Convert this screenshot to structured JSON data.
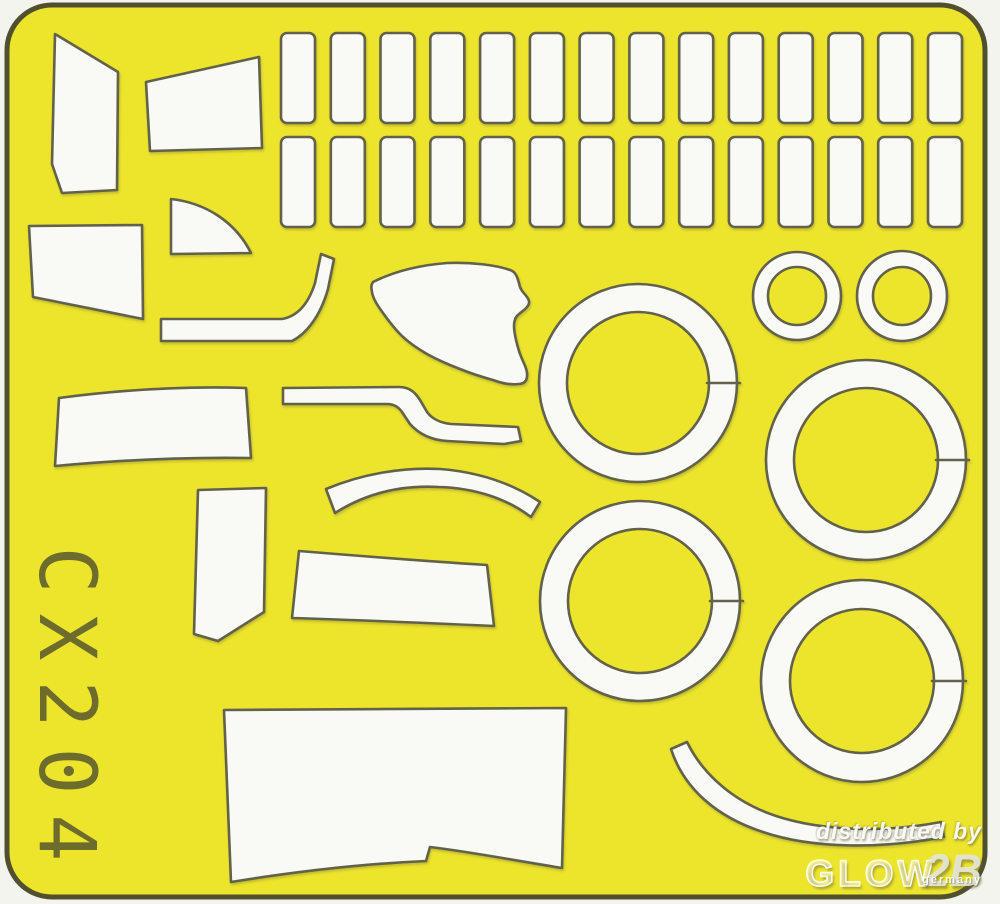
{
  "sheet": {
    "product_code": "CX204",
    "colors": {
      "page_background": "#f4f4ee",
      "sheet_yellow": "#ede42c",
      "sheet_border": "#50502f",
      "cut_outline": "#62624a",
      "mask_white": "#f9f9f6",
      "code_text": "#5c5c2e"
    },
    "frame": {
      "x": 7,
      "y": 5,
      "width": 978,
      "height": 892,
      "corner_radius": 45,
      "border_width": 5
    },
    "mask_grid": {
      "rows": 2,
      "cols": 14,
      "x_start": 281,
      "pitch": 49.77,
      "row_y": [
        33,
        137
      ],
      "mask_width": 34,
      "mask_height": 90,
      "corner_radius": 6
    },
    "rings_large": [
      {
        "name": "large-ring-1",
        "cx": 638,
        "cy": 383,
        "r_outer": 99,
        "r_inner": 71
      },
      {
        "name": "large-ring-2",
        "cx": 866,
        "cy": 460,
        "r_outer": 100,
        "r_inner": 72
      },
      {
        "name": "large-ring-3",
        "cx": 640,
        "cy": 601,
        "r_outer": 100,
        "r_inner": 72
      },
      {
        "name": "large-ring-4",
        "cx": 862,
        "cy": 681,
        "r_outer": 101,
        "r_inner": 72
      }
    ],
    "rings_small": [
      {
        "name": "small-ring-1",
        "cx": 797,
        "cy": 296,
        "r_outer": 44,
        "r_inner": 29
      },
      {
        "name": "small-ring-2",
        "cx": 902,
        "cy": 296,
        "r_outer": 45,
        "r_inner": 29
      }
    ],
    "mask_shapes": [
      {
        "name": "windscreen-side-panel-mask",
        "d": "M 55 34 L 118 72 L 117 190 L 62 193 L 52 164 Z"
      },
      {
        "name": "windscreen-top-panel-mask",
        "d": "M 146 82 L 259 57 L 262 148 L 150 151 Z"
      },
      {
        "name": "side-window-panel-mask",
        "d": "M 29 226 L 142 225 L 143 319 L 33 297 Z"
      },
      {
        "name": "quarter-disc-mask",
        "d": "M 171 254 L 171 199 C 207 203 236 223 251 253 Z"
      },
      {
        "name": "canopy-rail-hook-mask",
        "d": "M 161 319 L 282 319 C 299 316 309 302 315 283 L 321 254 L 334 259 L 328 289 C 320 317 306 334 292 341 L 161 341 Z"
      },
      {
        "name": "canopy-side-blob-mask",
        "d": "M 373 282 C 395 271 421 265 447 263 C 471 262 496 265 510 270 C 517 272 518 280 520 287 C 522 293 528 296 529 301 C 530 306 524 310 519 314 C 515 317 514 321 514 326 C 514 333 516 341 519 351 C 522 361 528 369 527 376 C 527 381 524 384 518 384 C 510 385 501 383 493 380 C 482 377 470 373 460 369 C 447 364 436 359 427 354 C 415 347 407 341 401 335 C 393 327 388 320 383 313 C 378 306 373 299 372 292 C 371 287 371 285 373 282 Z"
      },
      {
        "name": "stepped-strip-mask",
        "d": "M 283 388 L 399 387 C 409 387 415 392 420 400 L 427 412 C 432 419 441 423 451 424 L 518 427 L 521 441 L 504 444 L 447 441 C 431 440 419 434 410 424 L 402 412 C 398 406 393 404 387 404 L 283 404 Z"
      },
      {
        "name": "long-left-strip-mask",
        "d": "M 59 398 C 120 390 185 386 246 388 L 251 458 C 185 457 120 460 55 466 Z"
      },
      {
        "name": "tall-blade-mask",
        "d": "M 198 490 L 266 488 L 264 612 L 218 641 L 194 634 Z"
      },
      {
        "name": "eyebrow-arc-mask",
        "d": "M 326 489 C 362 474 402 467 440 469 C 479 472 513 484 540 502 L 531 517 C 506 498 474 488 439 487 C 404 485 368 492 335 513 Z"
      },
      {
        "name": "mid-strip-mask",
        "d": "M 299 551 C 360 556 424 561 487 565 L 494 626 C 427 623 359 620 292 618 Z"
      },
      {
        "name": "bottom-panel-mask",
        "d": "M 224 710 L 566 708 L 562 868 C 518 861 472 852 430 847 L 426 861 C 359 864 293 872 231 882 Z"
      },
      {
        "name": "bottom-bow-arc-mask",
        "d": "M 671 749 C 684 789 717 817 763 832 C 813 849 882 849 944 837 L 941 822 C 884 833 822 831 776 816 C 737 803 704 777 687 742 Z"
      }
    ]
  },
  "watermark": {
    "distributed_by": "distributed by",
    "brand": "GLOW",
    "brand_suffix": "2B",
    "country": "germany"
  }
}
